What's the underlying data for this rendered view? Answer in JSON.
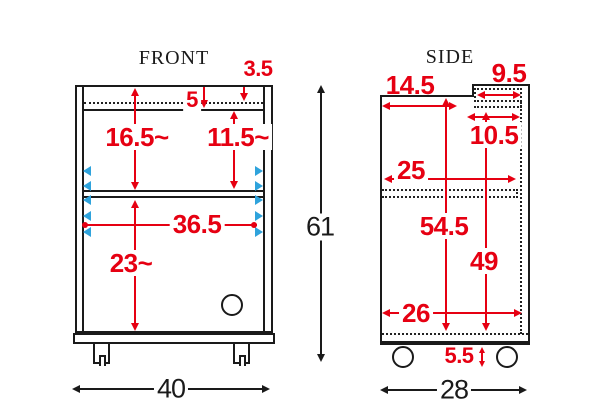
{
  "front": {
    "title": "FRONT",
    "dims": {
      "top_step": "3.5",
      "top_panel": "5",
      "upper_left_height": "16.5~",
      "upper_right_height": "11.5~",
      "interior_width": "36.5",
      "lower_height": "23~",
      "overall_height": "61",
      "overall_width": "40"
    }
  },
  "side": {
    "title": "SIDE",
    "dims": {
      "top_front_depth": "14.5",
      "notch_depth": "9.5",
      "back_top_depth": "10.5",
      "middle_depth": "25",
      "interior_height": "54.5",
      "back_interior_height": "49",
      "bottom_depth": "26",
      "caster_height": "5.5",
      "overall_depth": "28"
    }
  },
  "colors": {
    "dimension_red": "#e60012",
    "shelf_pin_blue": "#2fa3dc",
    "line_black": "#1a1a1a"
  }
}
